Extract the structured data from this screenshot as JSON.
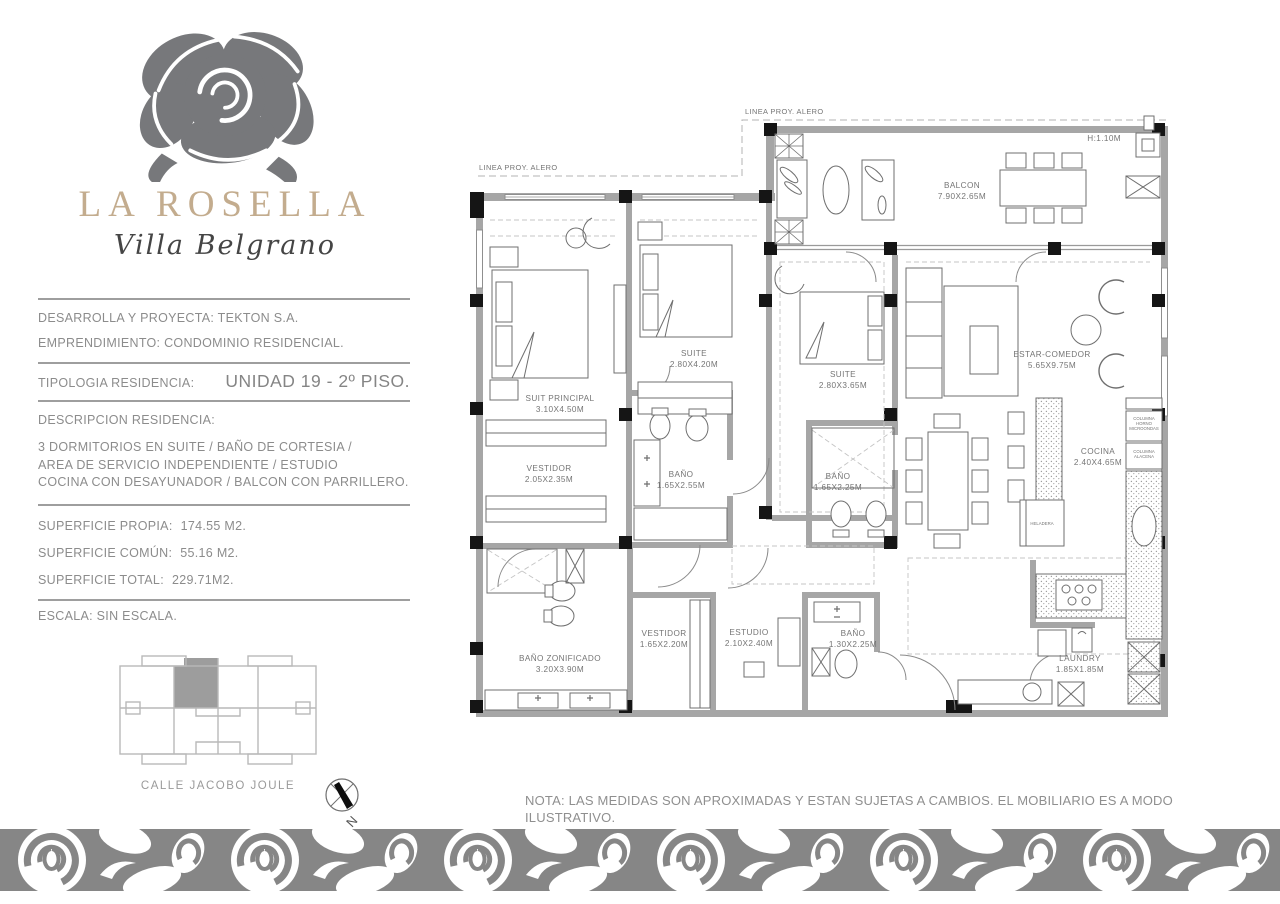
{
  "brand": {
    "name": "LA ROSELLA",
    "subtitle": "Villa Belgrano",
    "accent_color": "#c3ac8e",
    "rose_color": "#77787b"
  },
  "info": {
    "developer": "DESARROLLA Y PROYECTA: TEKTON S.A.",
    "project": "EMPRENDIMIENTO: CONDOMINIO RESIDENCIAL.",
    "typology_label": "TIPOLOGIA RESIDENCIA:",
    "typology_value": "UNIDAD 19 - 2º PISO.",
    "description_label": "DESCRIPCION RESIDENCIA:",
    "description_lines": [
      "3 DORMITORIOS EN SUITE / BAÑO DE CORTESIA /",
      "AREA DE SERVICIO INDEPENDIENTE / ESTUDIO",
      "COCINA CON DESAYUNADOR / BALCON CON PARRILLERO."
    ],
    "surfaces": [
      {
        "label": "SUPERFICIE PROPIA:",
        "value": "174.55 M2."
      },
      {
        "label": "SUPERFICIE COMÚN:",
        "value": "55.16 M2."
      },
      {
        "label": "SUPERFICIE TOTAL:",
        "value": "229.71M2."
      }
    ],
    "scale": "ESCALA: SIN ESCALA."
  },
  "key_plan": {
    "street": "CALLE JACOBO JOULE",
    "compass": "N"
  },
  "plan": {
    "alero_label": "LINEA PROY. ALERO",
    "height_note": "H:1.10M",
    "rooms": [
      {
        "name": "BALCON",
        "dims": "7.90X2.65M"
      },
      {
        "name": "SUIT PRINCIPAL",
        "dims": "3.10X4.50M"
      },
      {
        "name": "SUITE",
        "dims": "2.80X4.20M"
      },
      {
        "name": "SUITE",
        "dims": "2.80X3.65M"
      },
      {
        "name": "ESTAR-COMEDOR",
        "dims": "5.65X9.75M"
      },
      {
        "name": "VESTIDOR",
        "dims": "2.05X2.35M"
      },
      {
        "name": "BAÑO",
        "dims": "1.65X2.55M"
      },
      {
        "name": "BAÑO",
        "dims": "1.65X2.25M"
      },
      {
        "name": "COCINA",
        "dims": "2.40X4.65M"
      },
      {
        "name": "BAÑO  ZONIFICADO",
        "dims": "3.20X3.90M"
      },
      {
        "name": "VESTIDOR",
        "dims": "1.65X2.20M"
      },
      {
        "name": "ESTUDIO",
        "dims": "2.10X2.40M"
      },
      {
        "name": "BAÑO",
        "dims": "1.30X2.25M"
      },
      {
        "name": "LAUNDRY",
        "dims": "1.85X1.85M"
      }
    ],
    "fixtures": {
      "fridge": "HELADERA",
      "column_oven": [
        "COLUMNA",
        "HORNO",
        "MICROONDAS"
      ],
      "column_pantry": [
        "COLUMNA",
        "ALACENA"
      ]
    }
  },
  "note": {
    "line1": "NOTA: LAS MEDIDAS SON APROXIMADAS Y ESTAN SUJETAS A CAMBIOS. EL MOBILIARIO ES A MODO ILUSTRATIVO.",
    "line2": "PROPIEDAD INTELECTUAL Y DERECHOS RESERVADOS."
  }
}
